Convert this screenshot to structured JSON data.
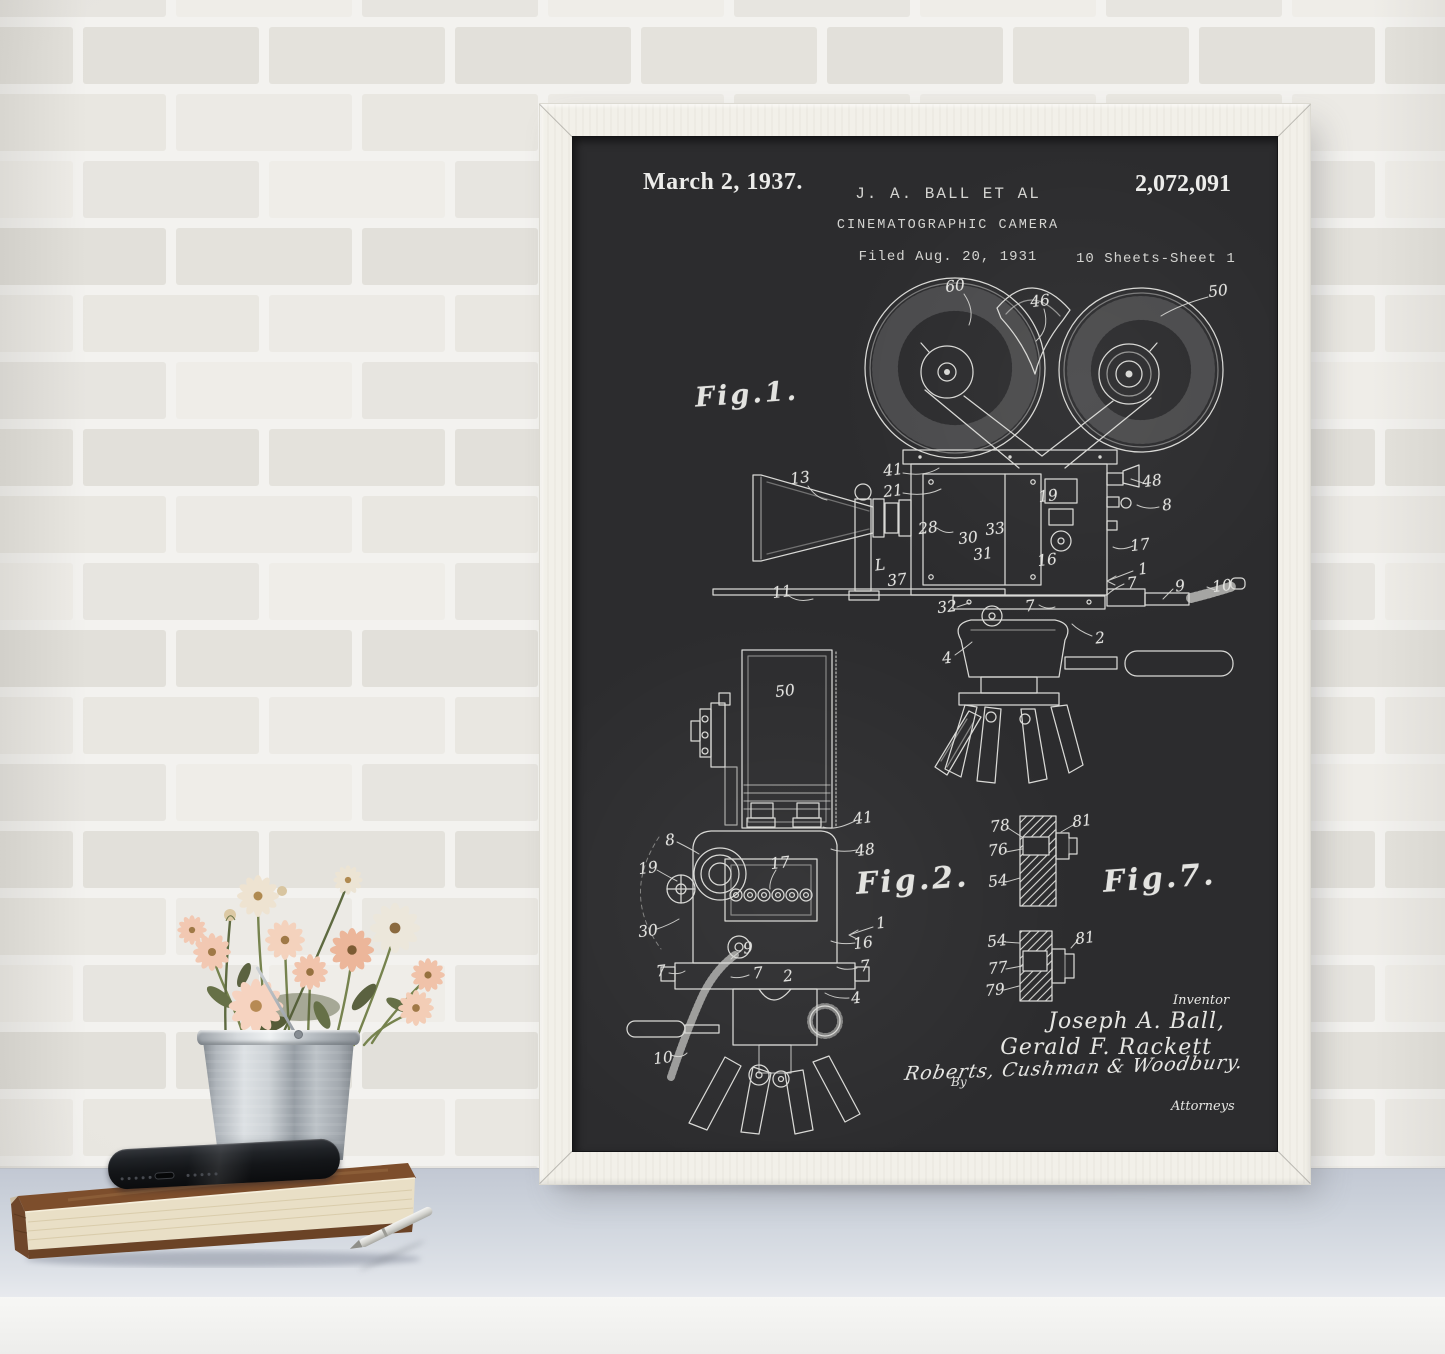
{
  "scene": {
    "wall": {
      "mortar_color": "#f3f2ef",
      "brick_shades": [
        "#e7e5e0",
        "#eceae5",
        "#e2e0da",
        "#efede8",
        "#e9e7e1",
        "#e4e2dc"
      ]
    },
    "table": {
      "top_color": "#ccd2db",
      "front_color": "#f2f2f0"
    }
  },
  "poster": {
    "frame_color": "#f2f0e9",
    "board_color": "#2c2c2e",
    "chalk_color": "#d9d9d6",
    "header": {
      "date": "March 2, 1937.",
      "author": "J. A. BALL ET AL",
      "title": "CINEMATOGRAPHIC CAMERA",
      "filed": "Filed Aug. 20, 1931",
      "patent_number": "2,072,091",
      "sheet_info": "10 Sheets-Sheet 1"
    },
    "figures": {
      "fig1": {
        "label": "Fig.1.",
        "refs": [
          {
            "t": "60",
            "x": 382,
            "y": 149
          },
          {
            "t": "46",
            "x": 467,
            "y": 164
          },
          {
            "t": "50",
            "x": 645,
            "y": 154
          },
          {
            "t": "13",
            "x": 227,
            "y": 341
          },
          {
            "t": "41",
            "x": 320,
            "y": 333
          },
          {
            "t": "21",
            "x": 320,
            "y": 354
          },
          {
            "t": "28",
            "x": 355,
            "y": 391
          },
          {
            "t": "30",
            "x": 395,
            "y": 401
          },
          {
            "t": "33",
            "x": 422,
            "y": 392
          },
          {
            "t": "31",
            "x": 410,
            "y": 417
          },
          {
            "t": "L",
            "x": 307,
            "y": 428
          },
          {
            "t": "37",
            "x": 324,
            "y": 443
          },
          {
            "t": "11",
            "x": 209,
            "y": 455
          },
          {
            "t": "32",
            "x": 374,
            "y": 470
          },
          {
            "t": "19",
            "x": 475,
            "y": 359
          },
          {
            "t": "16",
            "x": 474,
            "y": 423
          },
          {
            "t": "48",
            "x": 579,
            "y": 344
          },
          {
            "t": "8",
            "x": 594,
            "y": 368
          },
          {
            "t": "17",
            "x": 567,
            "y": 408
          },
          {
            "t": "1",
            "x": 570,
            "y": 432
          },
          {
            "t": "7",
            "x": 559,
            "y": 446
          },
          {
            "t": "9",
            "x": 607,
            "y": 449
          },
          {
            "t": "10",
            "x": 649,
            "y": 449
          },
          {
            "t": "7",
            "x": 457,
            "y": 469
          },
          {
            "t": "2",
            "x": 527,
            "y": 501
          },
          {
            "t": "4",
            "x": 374,
            "y": 521
          }
        ]
      },
      "fig2": {
        "label": "Fig.2.",
        "refs": [
          {
            "t": "50",
            "x": 212,
            "y": 554
          },
          {
            "t": "41",
            "x": 290,
            "y": 681
          },
          {
            "t": "48",
            "x": 292,
            "y": 713
          },
          {
            "t": "8",
            "x": 97,
            "y": 703
          },
          {
            "t": "19",
            "x": 75,
            "y": 731
          },
          {
            "t": "17",
            "x": 207,
            "y": 726
          },
          {
            "t": "30",
            "x": 75,
            "y": 794
          },
          {
            "t": "1",
            "x": 308,
            "y": 786
          },
          {
            "t": "16",
            "x": 290,
            "y": 806
          },
          {
            "t": "9",
            "x": 175,
            "y": 811
          },
          {
            "t": "7",
            "x": 88,
            "y": 834
          },
          {
            "t": "7",
            "x": 185,
            "y": 836
          },
          {
            "t": "2",
            "x": 215,
            "y": 839
          },
          {
            "t": "7",
            "x": 292,
            "y": 829
          },
          {
            "t": "4",
            "x": 283,
            "y": 861
          },
          {
            "t": "10",
            "x": 90,
            "y": 921
          }
        ]
      },
      "fig7": {
        "label": "Fig.7.",
        "refs": [
          {
            "t": "78",
            "x": 427,
            "y": 689
          },
          {
            "t": "76",
            "x": 425,
            "y": 713
          },
          {
            "t": "54",
            "x": 425,
            "y": 744
          },
          {
            "t": "81",
            "x": 509,
            "y": 684
          },
          {
            "t": "54",
            "x": 424,
            "y": 804
          },
          {
            "t": "81",
            "x": 512,
            "y": 801
          },
          {
            "t": "77",
            "x": 425,
            "y": 831
          },
          {
            "t": "79",
            "x": 422,
            "y": 853
          }
        ]
      }
    },
    "signature_block": {
      "inventor_label": "Inventor",
      "inventor_1": "Joseph A. Ball,",
      "inventor_2": "Gerald F. Rackett",
      "by_label": "By",
      "attorneys_signature": "Roberts, Cushman & Woodbury.",
      "attorneys_label": "Attorneys"
    }
  },
  "props": {
    "bucket": {
      "metal_light": "#dde1e4",
      "metal_dark": "#82888e"
    },
    "flowers": {
      "petal_peach": "#f2c8b2",
      "petal_cream": "#ece7db",
      "center_brown": "#a07947",
      "leaf_green": "#667047",
      "stem_green": "#76834e"
    },
    "book": {
      "cover_brown": "#7d4e2c",
      "pages_cream": "#e9dfc6"
    },
    "phone": {
      "body_black": "#141619"
    },
    "pen": {
      "body_silver": "#d2d2cd"
    }
  }
}
